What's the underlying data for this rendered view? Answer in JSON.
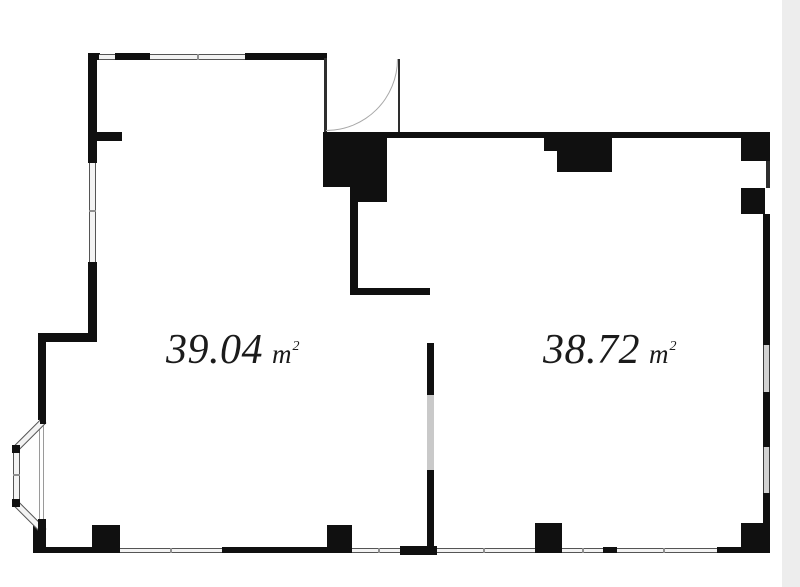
{
  "colors": {
    "wall": "#101010",
    "window_fill": "#f3f3f3",
    "window_line": "#555555",
    "glass_gray": "#d2d2d2",
    "gutter": "#ededed",
    "background": "#ffffff",
    "text": "#1b1b1b"
  },
  "rooms": [
    {
      "name": "left-room",
      "area_value": "39.04",
      "area_unit": "m",
      "area_exponent": "2"
    },
    {
      "name": "right-room",
      "area_value": "38.72",
      "area_unit": "m",
      "area_exponent": "2"
    }
  ]
}
